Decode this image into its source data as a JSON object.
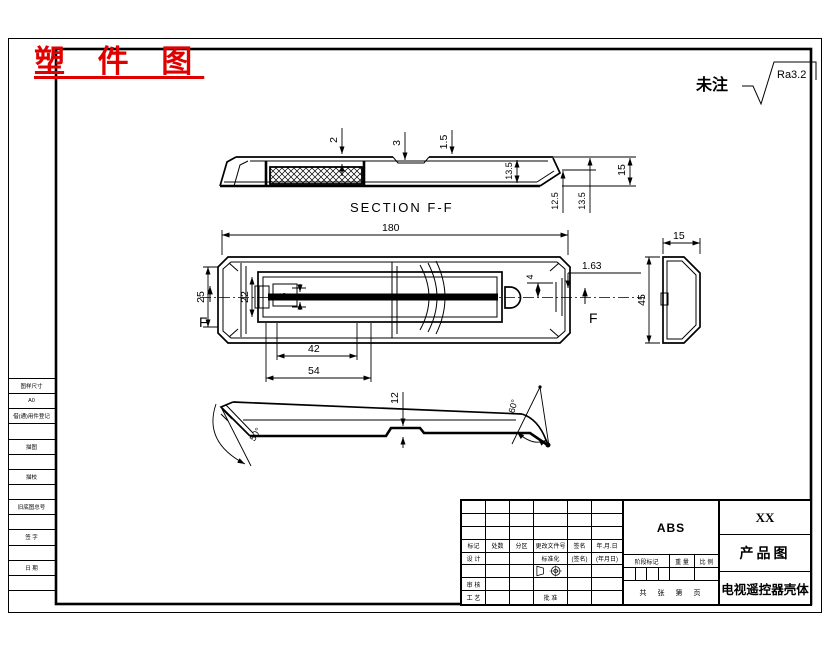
{
  "stamp": {
    "text": "塑 件 图"
  },
  "roughness": {
    "label": "未注",
    "value": "Ra3.2"
  },
  "views": {
    "section": {
      "caption": "SECTION  F-F",
      "dims": {
        "wall": "2",
        "rib": "3",
        "lip": "1.5",
        "inner_height": "13.5",
        "tail_a": "12.5",
        "tail_b": "13.5",
        "end_height": "15"
      }
    },
    "plan": {
      "section_letter": "F",
      "dims": {
        "length": "180",
        "opening": "25",
        "inner": "22",
        "slot": "5",
        "cover_a": "42",
        "cover_b": "54",
        "offset": "4",
        "gap": "1.63"
      }
    },
    "side": {
      "dims": {
        "depth": "15",
        "height": "45"
      }
    },
    "bottom": {
      "dims": {
        "step": "12",
        "angle_left": "50°",
        "angle_right": "60°"
      }
    }
  },
  "left_strip": {
    "rows": [
      "图样尺寸",
      "A0",
      "借(通)用件登记",
      "",
      "描图",
      "",
      "描校",
      "",
      "旧底图总号",
      "",
      "签 字",
      "",
      "日 期",
      "",
      ""
    ]
  },
  "title_block": {
    "material": "ABS",
    "company": "XX",
    "drawing_type": "产品图",
    "part_name": "电视遥控器壳体",
    "rev_headers": [
      "标记",
      "处数",
      "分区",
      "更改文件号",
      "签名",
      "年.月.日"
    ],
    "design": "设 计",
    "standardization": "标准化",
    "sig": "(签名)",
    "date": "(年月日)",
    "audit": "审 核",
    "process": "工 艺",
    "approve": "批 准",
    "stage_mark": "阶段标记",
    "weight": "重 量",
    "scale": "比 例",
    "sheet": "共　张　第　页"
  }
}
